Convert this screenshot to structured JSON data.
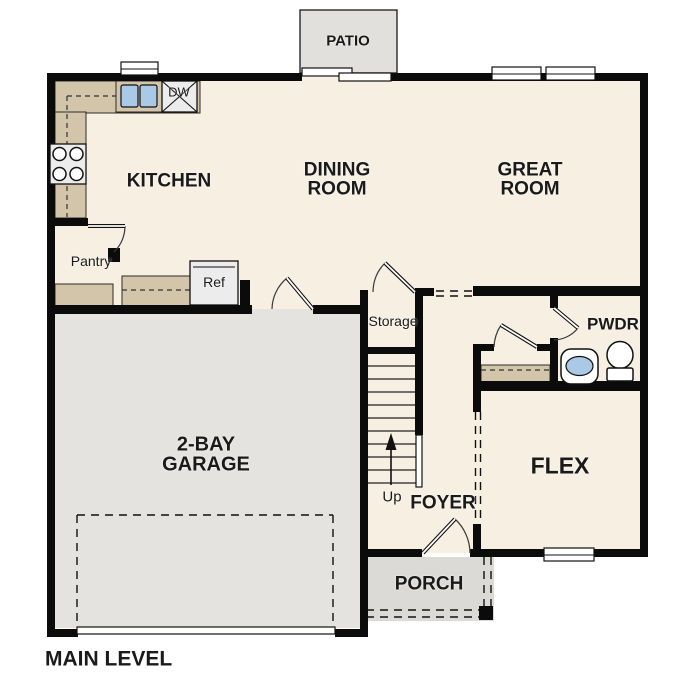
{
  "plan_title": "MAIN LEVEL",
  "rooms": {
    "kitchen": {
      "label": "KITCHEN"
    },
    "dining_room": {
      "label": "DINING\nROOM"
    },
    "great_room": {
      "label": "GREAT\nROOM"
    },
    "garage": {
      "label": "2-BAY\nGARAGE"
    },
    "flex": {
      "label": "FLEX"
    },
    "foyer": {
      "label": "FOYER"
    },
    "porch": {
      "label": "PORCH"
    },
    "patio": {
      "label": "PATIO"
    },
    "powder_room": {
      "label": "PWDR"
    },
    "pantry": {
      "label": "Pantry"
    },
    "storage": {
      "label": "Storage"
    }
  },
  "annotations": {
    "dishwasher": "DW",
    "refrigerator": "Ref",
    "stair_direction": "Up"
  },
  "colors": {
    "floor": "#f7efe2",
    "garage_floor": "#e5e3df",
    "patio_floor": "#e2e0dc",
    "porch_floor": "#dcdad6",
    "counter": "#d2c5a9",
    "sink_water": "#a9c9e6",
    "wall": "#0b0b0b"
  }
}
